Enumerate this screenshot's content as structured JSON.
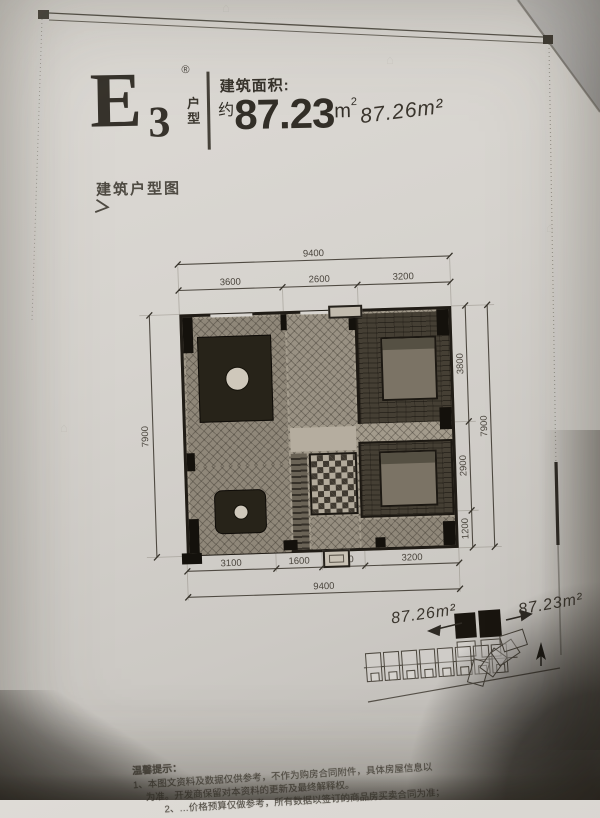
{
  "photo": {
    "watermark_glyph": "⌂"
  },
  "colors": {
    "paper": "#d4d1cc",
    "ink": "#37332c",
    "plan_dark": "#14110c",
    "handwriting": "#3b362e",
    "background": "#aeacaa"
  },
  "header": {
    "unit_code_letter": "E",
    "unit_code_number": "3",
    "registered_mark": "®",
    "unit_type_label": "户型",
    "area_caption": "建筑面积:",
    "area_approx_prefix": "约",
    "area_value": "87.23",
    "area_unit_base": "m",
    "area_unit_sup": "2",
    "handwritten_area": "87.26m²"
  },
  "section": {
    "title": "建筑户型图",
    "arrow_glyph": "＞"
  },
  "floor_plan": {
    "dim_top_total": "9400",
    "dims_top": [
      "3600",
      "2600",
      "3200"
    ],
    "dim_left_total": "7900",
    "dims_right": [
      "3800",
      "2900",
      "1200"
    ],
    "dim_right_total": "7900",
    "dims_bottom": [
      "3100",
      "1600",
      "1500",
      "3200"
    ],
    "dim_bottom_total": "9400"
  },
  "site_plan": {
    "handwritten_left": "87.26m²",
    "handwritten_right": "87.23m²"
  },
  "disclaimer": {
    "title": "温馨提示：",
    "line1": "1、本图文资料及数据仅供参考，不作为购房合同附件，具体房屋信息以",
    "line2": "为准。开发商保留对本资料的更新及最终解释权。",
    "line3": "2、…价格预算仅做参考，所有数据以签订的商品房买卖合同为准；"
  }
}
